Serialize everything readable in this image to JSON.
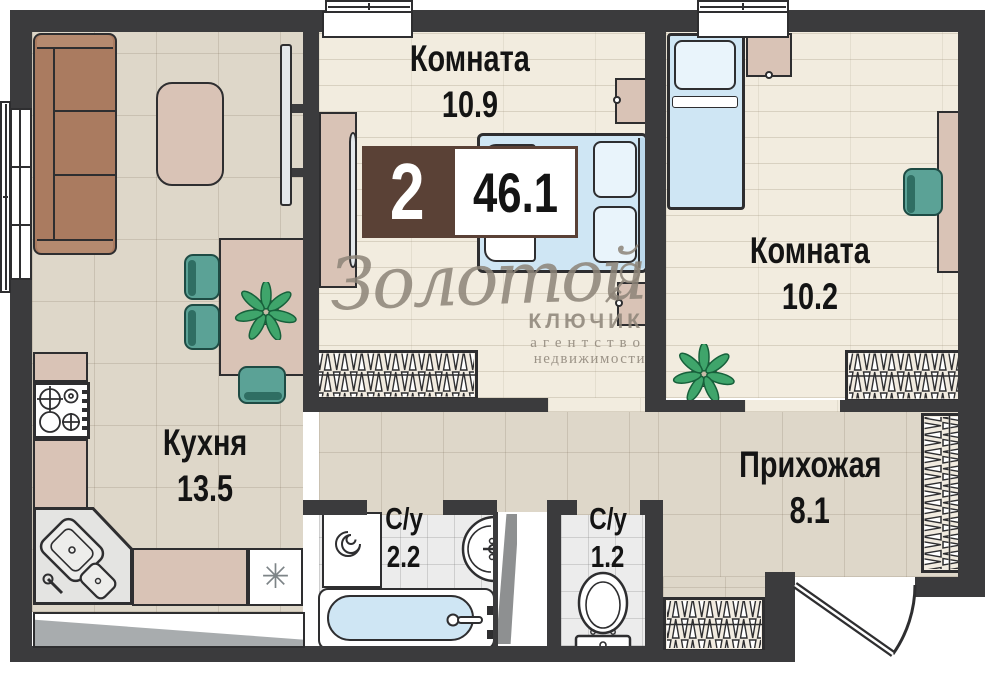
{
  "plan": {
    "badge": {
      "rooms_count": "2",
      "total_area": "46.1"
    },
    "rooms": {
      "room1": {
        "name": "Комната",
        "area": "10.9"
      },
      "room2": {
        "name": "Комната",
        "area": "10.2"
      },
      "kitchen": {
        "name": "Кухня",
        "area": "13.5"
      },
      "hallway": {
        "name": "Прихожая",
        "area": "8.1"
      },
      "bathroom": {
        "name": "С/у",
        "area": "2.2"
      },
      "toilet": {
        "name": "С/у",
        "area": "1.2"
      }
    },
    "watermark": {
      "brand_script": "Золотой",
      "brand_word": "КЛЮЧИК",
      "brand_line1": "агентство",
      "brand_line2": "недвижимости"
    },
    "icons": {
      "fridge": "✳"
    },
    "colors": {
      "wall": "#3b3b3d",
      "badge_brown": "#5a4136",
      "bed_blue": "#cfe6f4",
      "chair_teal": "#5ba296",
      "sofa_brown": "#aa7b60",
      "furniture_beige": "#d9c3b6",
      "plant_green": "#3fa56b",
      "watermark_grey": "#8d8478"
    }
  }
}
